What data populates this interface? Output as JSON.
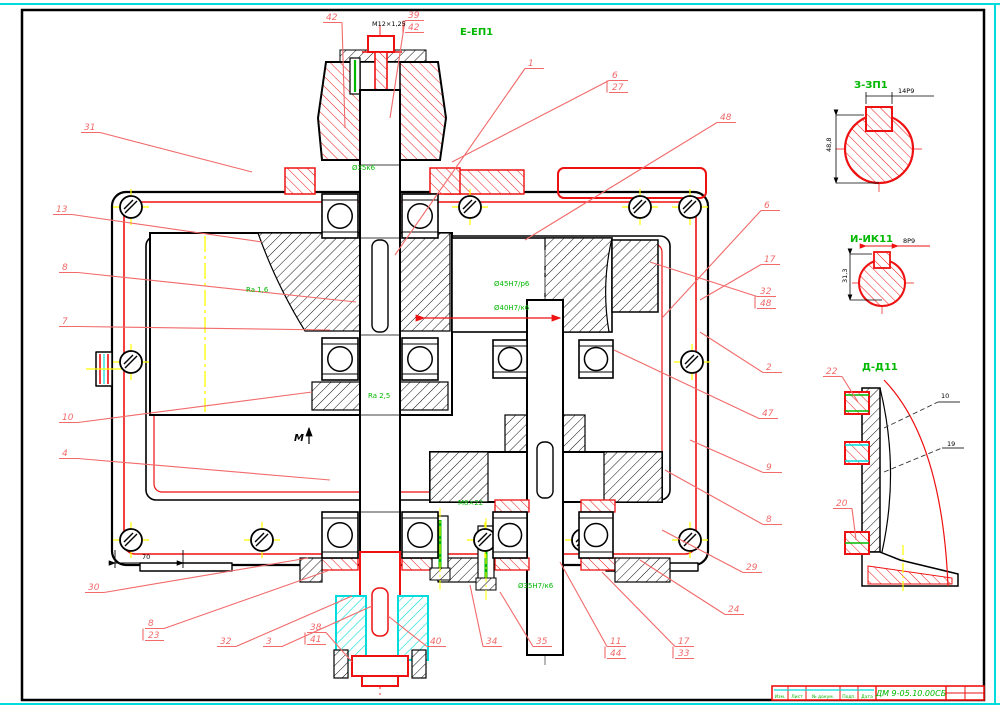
{
  "colors": {
    "part_red": "#ee1111",
    "leader_red": "#f26a6a",
    "green": "#00b800",
    "cyan": "#00dcdc",
    "yellow": "#ffff00",
    "black": "#000000",
    "grey_centerline": "#707070",
    "white": "#ffffff"
  },
  "views": {
    "section_e_label": "Е-ЕП1",
    "section_z_label": "З-ЗП1",
    "section_i_label": "И-ИК11",
    "section_d_label": "Д-Д11",
    "view_m_label": "М"
  },
  "title_block": {
    "doc_number": "ДМ 9-05.10.00СБ",
    "cols": [
      "Изм.",
      "Лист",
      "№ докум.",
      "Подп.",
      "Дата"
    ]
  },
  "callouts": [
    {
      "n": "42",
      "x": 326,
      "y": 20,
      "ex": 345,
      "ey": 128
    },
    {
      "n": "39",
      "n2": "42",
      "x": 408,
      "y": 18,
      "ex": 390,
      "ey": 118
    },
    {
      "n": "1",
      "x": 528,
      "y": 66,
      "ex": 395,
      "ey": 255
    },
    {
      "n": "6",
      "n2": "27",
      "x": 612,
      "y": 78,
      "ex": 452,
      "ey": 162
    },
    {
      "n": "48",
      "x": 720,
      "y": 120,
      "ex": 525,
      "ey": 240
    },
    {
      "n": "31",
      "x": 84,
      "y": 130,
      "ex": 252,
      "ey": 172
    },
    {
      "n": "13",
      "x": 56,
      "y": 212,
      "ex": 262,
      "ey": 242
    },
    {
      "n": "8",
      "x": 62,
      "y": 270,
      "ex": 356,
      "ey": 302
    },
    {
      "n": "7",
      "x": 62,
      "y": 324,
      "ex": 330,
      "ey": 330
    },
    {
      "n": "10",
      "x": 62,
      "y": 420,
      "ex": 312,
      "ey": 392
    },
    {
      "n": "4",
      "x": 62,
      "y": 456,
      "ex": 330,
      "ey": 480
    },
    {
      "n": "30",
      "x": 88,
      "y": 590,
      "ex": 308,
      "ey": 558
    },
    {
      "n": "8",
      "n2": "23",
      "x": 148,
      "y": 626,
      "ex": 330,
      "ey": 570
    },
    {
      "n": "32",
      "x": 220,
      "y": 644,
      "ex": 352,
      "ey": 596
    },
    {
      "n": "3",
      "x": 266,
      "y": 644,
      "ex": 372,
      "ey": 606
    },
    {
      "n": "38",
      "n2": "41",
      "x": 310,
      "y": 630,
      "ex": 352,
      "ey": 662
    },
    {
      "n": "40",
      "x": 430,
      "y": 644,
      "ex": 388,
      "ey": 616
    },
    {
      "n": "34",
      "x": 486,
      "y": 644,
      "ex": 470,
      "ey": 585
    },
    {
      "n": "35",
      "x": 536,
      "y": 644,
      "ex": 500,
      "ey": 592
    },
    {
      "n": "11",
      "n2": "44",
      "x": 610,
      "y": 644,
      "ex": 560,
      "ey": 562
    },
    {
      "n": "17",
      "n2": "33",
      "x": 678,
      "y": 644,
      "ex": 602,
      "ey": 572
    },
    {
      "n": "24",
      "x": 728,
      "y": 612,
      "ex": 640,
      "ey": 560
    },
    {
      "n": "29",
      "x": 746,
      "y": 570,
      "ex": 662,
      "ey": 530
    },
    {
      "n": "8",
      "x": 766,
      "y": 522,
      "ex": 665,
      "ey": 470
    },
    {
      "n": "9",
      "x": 766,
      "y": 470,
      "ex": 690,
      "ey": 440
    },
    {
      "n": "47",
      "x": 762,
      "y": 416,
      "ex": 614,
      "ey": 350
    },
    {
      "n": "2",
      "x": 766,
      "y": 370,
      "ex": 700,
      "ey": 332
    },
    {
      "n": "32",
      "n2": "48",
      "x": 760,
      "y": 294,
      "ex": 650,
      "ey": 262
    },
    {
      "n": "17",
      "x": 764,
      "y": 262,
      "ex": 700,
      "ey": 300
    },
    {
      "n": "6",
      "x": 764,
      "y": 208,
      "ex": 662,
      "ey": 318
    },
    {
      "n": "22",
      "x": 826,
      "y": 374,
      "ex": 858,
      "ey": 402
    },
    {
      "n": "20",
      "x": 836,
      "y": 506,
      "ex": 856,
      "ey": 540
    }
  ],
  "green_notes": [
    {
      "t": "Ø35к6",
      "x": 352,
      "y": 170
    },
    {
      "t": "Ra 1,6",
      "x": 246,
      "y": 292
    },
    {
      "t": "Ø45Н7/р6",
      "x": 494,
      "y": 286
    },
    {
      "t": "Ø40Н7/к6",
      "x": 494,
      "y": 310
    },
    {
      "t": "М8×22",
      "x": 458,
      "y": 505
    },
    {
      "t": "Ø35Н7/к6",
      "x": 518,
      "y": 588
    },
    {
      "t": "Ra 2,5",
      "x": 368,
      "y": 398
    }
  ],
  "dim_notes": [
    {
      "t": "М12×1,25",
      "x": 372,
      "y": 26
    },
    {
      "t": "70",
      "x": 142,
      "y": 559
    },
    {
      "t": "14Р9",
      "x": 898,
      "y": 93
    },
    {
      "t": "48,8",
      "x": 831,
      "y": 152,
      "rot": -90
    },
    {
      "t": "8Р9",
      "x": 903,
      "y": 243
    },
    {
      "t": "31,3",
      "x": 847,
      "y": 283,
      "rot": -90
    },
    {
      "t": "10",
      "x": 941,
      "y": 398
    },
    {
      "t": "19",
      "x": 947,
      "y": 446
    }
  ]
}
